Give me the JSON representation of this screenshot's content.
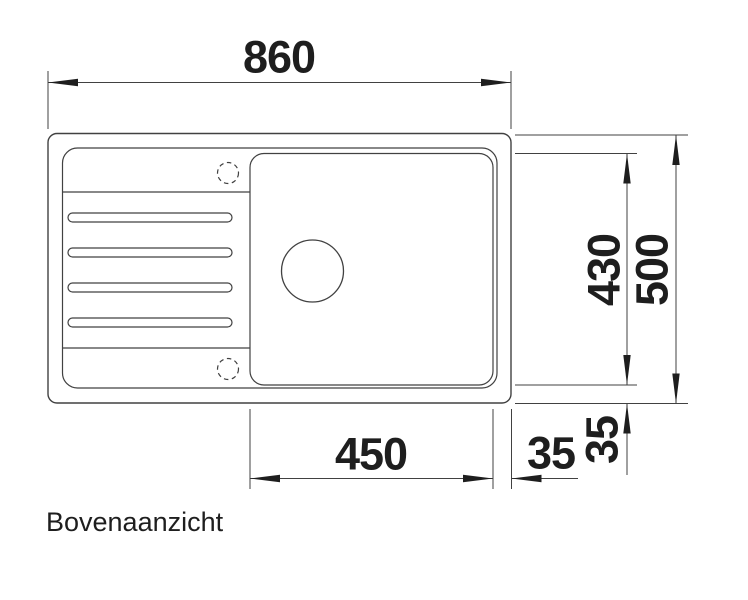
{
  "drawing": {
    "view_label": "Bovenaanzicht",
    "dims": {
      "overall_width": "860",
      "overall_depth": "500",
      "bowl_width": "450",
      "bowl_depth": "430",
      "edge_offset_right": "35",
      "edge_offset_bottom": "35"
    },
    "colors": {
      "line": "#414141",
      "text": "#1e1e1e"
    }
  }
}
